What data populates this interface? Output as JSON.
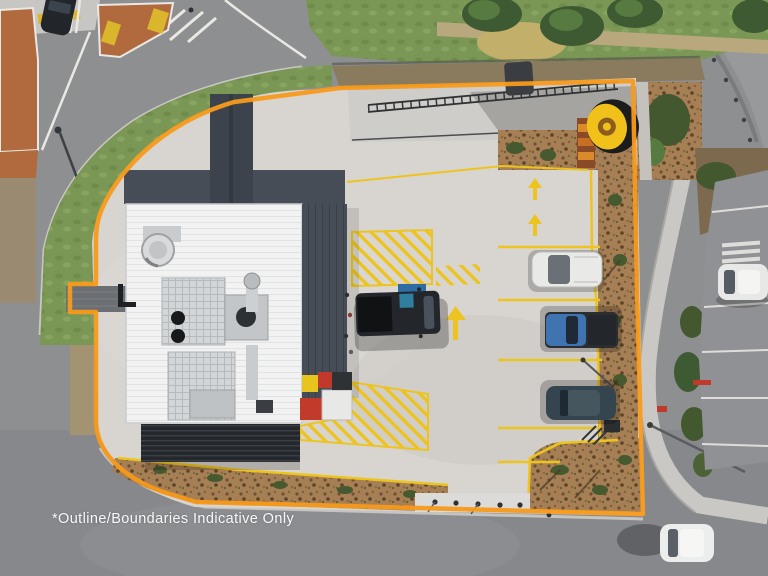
{
  "photo": {
    "kind": "aerial drone photograph",
    "subject": "drive-thru restaurant site with indicative property boundary outline",
    "caption": "*Outline/Boundaries Indicative Only"
  },
  "colors": {
    "boundary_orange": "#F79A1B",
    "road_asphalt": "#8E8F91",
    "concrete": "#D8D5D0",
    "grass": "#7B9755",
    "mulch": "#A67F55",
    "roof_white": "#F2F3F2",
    "roof_dark": "#474D56",
    "marking_yellow": "#EDC41F",
    "sign_yellow": "#F0C11B",
    "island_terracotta": "#B06A3E",
    "accessible_blue": "#2E6DA4"
  },
  "objects": {
    "building": "restaurant with white metal roof, dark canopies and rooftop HVAC plant",
    "boundary": "orange indicative site outline",
    "pylon_sign": "round yellow sign on panel pylon",
    "vehicles": [
      "black dual-cab ute at accessible bay",
      "white van in parking bay",
      "blue ute in parking bay",
      "dark blue car in parking bay",
      "dark car at intersection",
      "white car on lower road",
      "white car in side parking lot"
    ],
    "markings": [
      "yellow hatched zones",
      "yellow parking bay lines",
      "lane arrows",
      "accessible parking symbol"
    ]
  }
}
